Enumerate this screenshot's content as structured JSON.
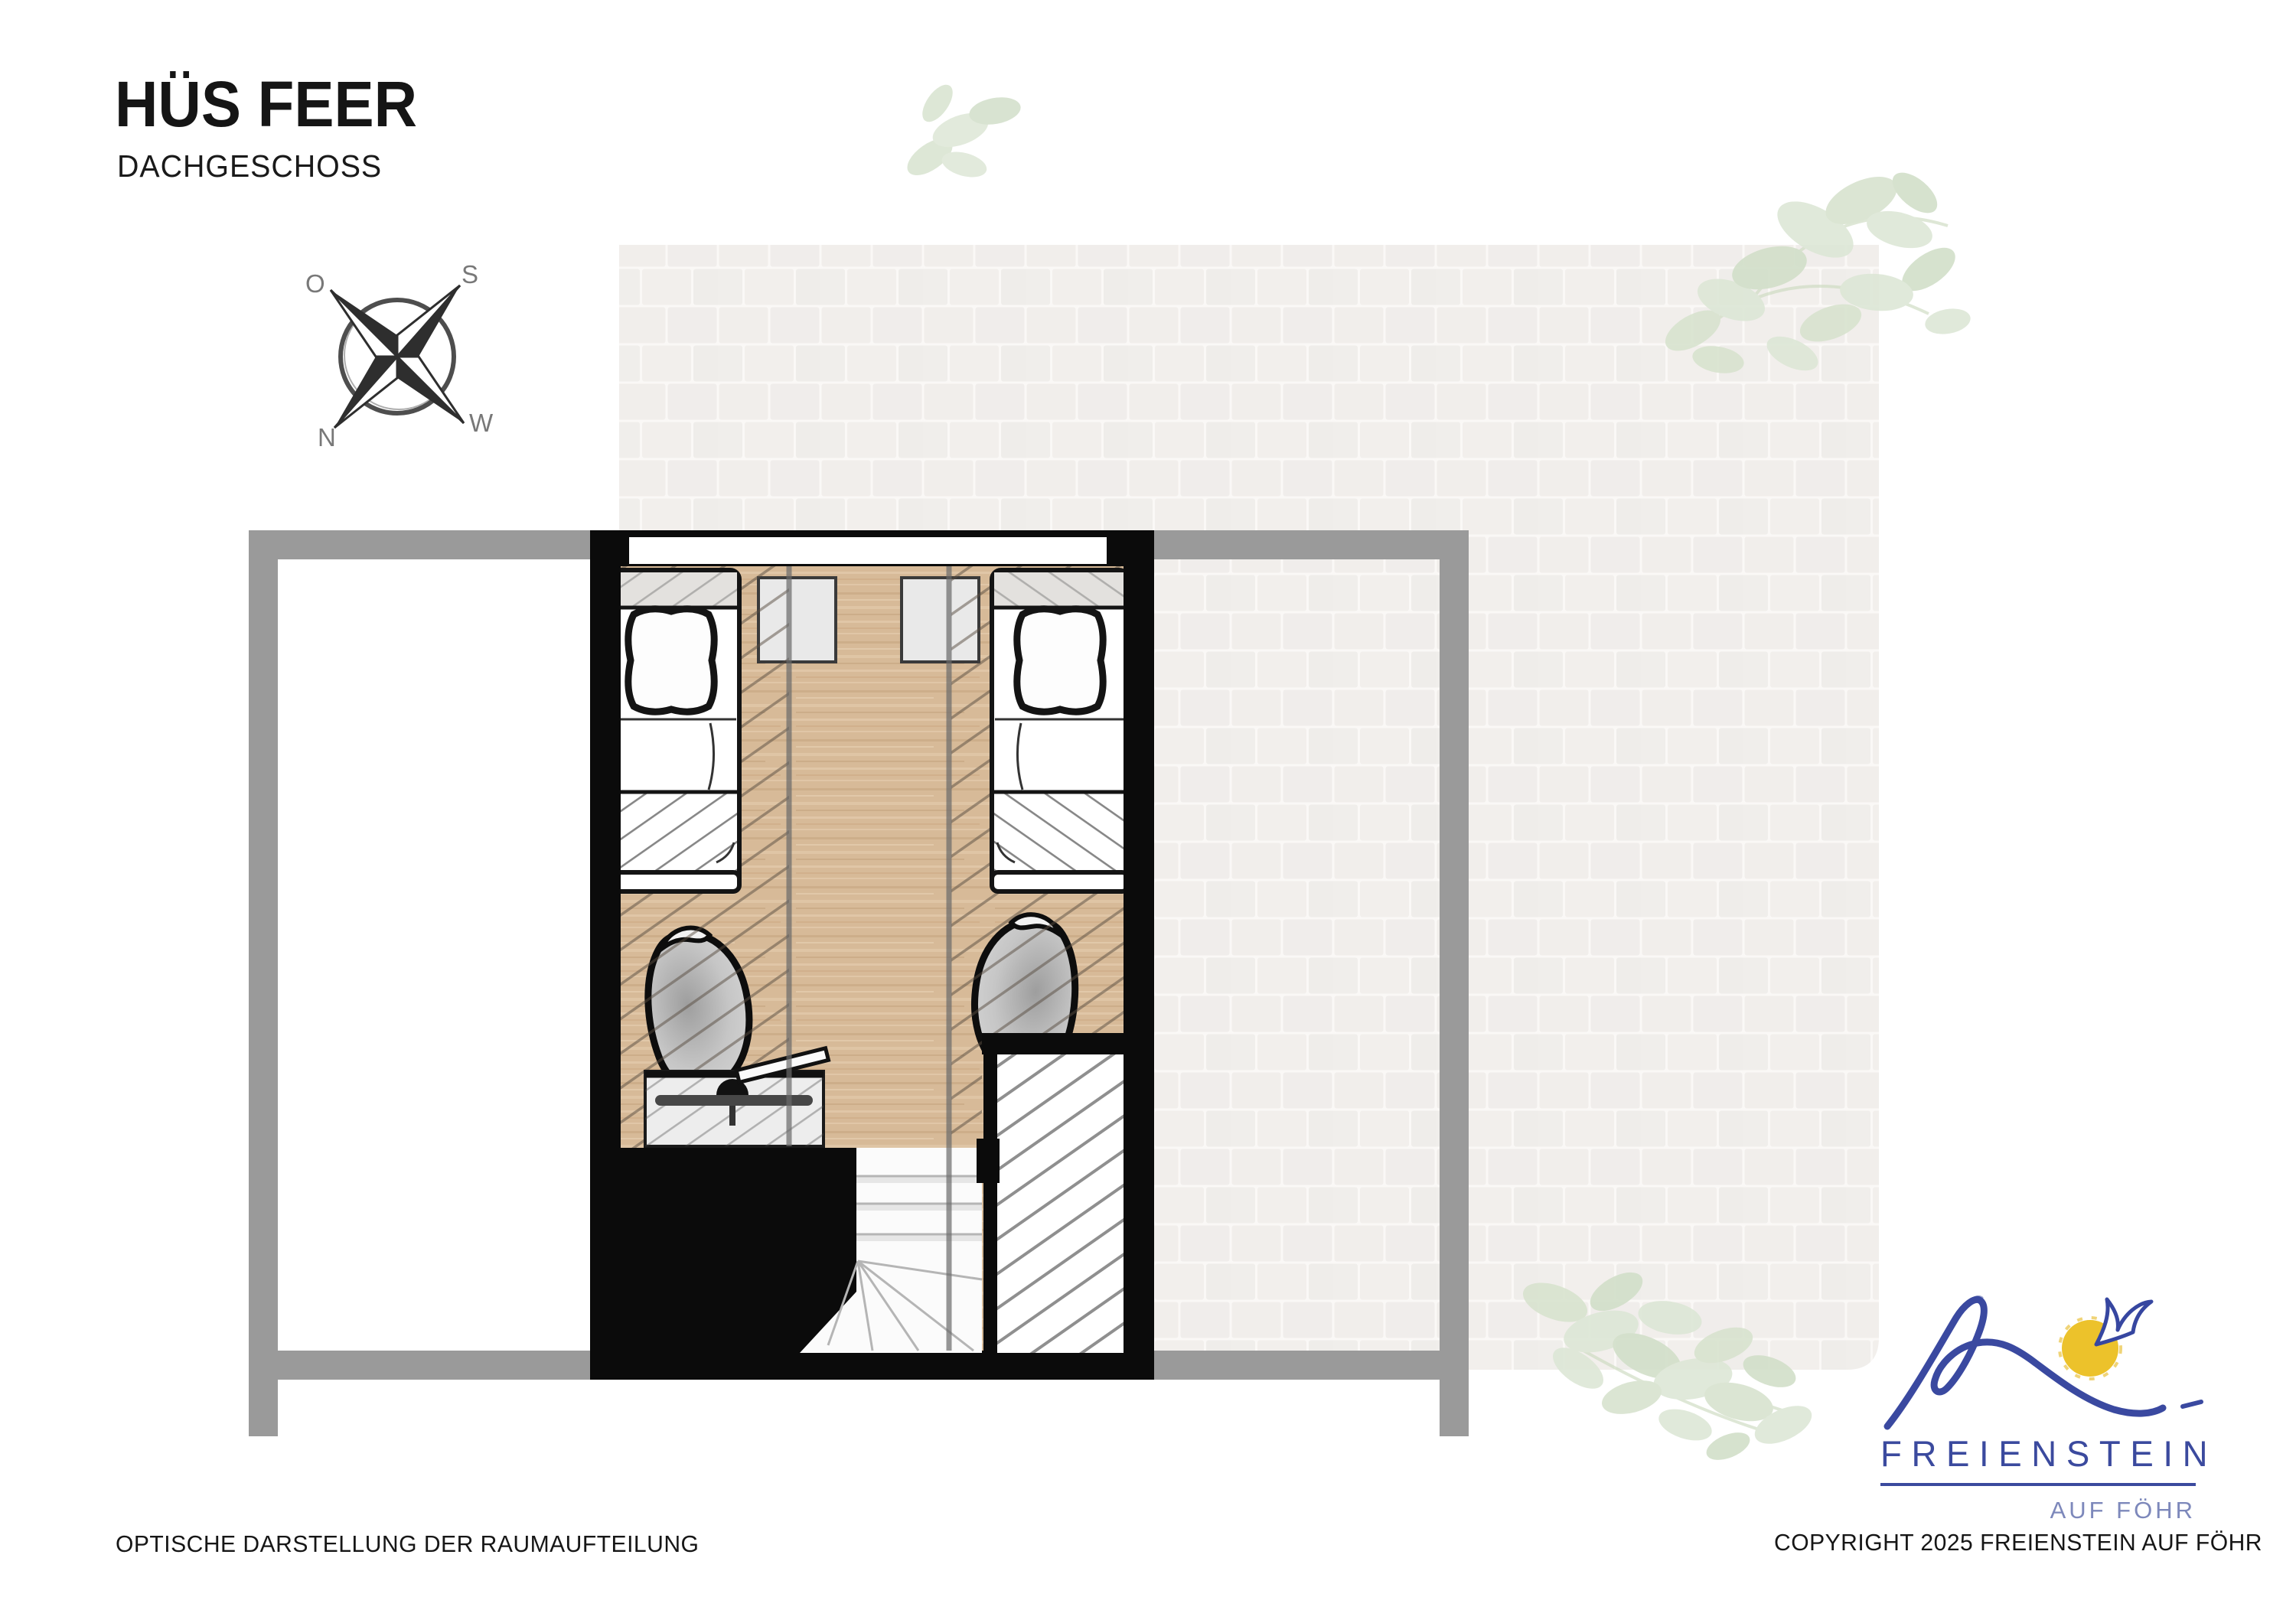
{
  "page": {
    "title": "HÜS FEER",
    "subtitle": "DACHGESCHOSS"
  },
  "compass": {
    "o": "O",
    "s": "S",
    "n": "N",
    "w": "W"
  },
  "footer": {
    "left": "OPTISCHE DARSTELLUNG DER RAUMAUFTEILUNG",
    "right": "COPYRIGHT 2025 FREIENSTEIN AUF FÖHR"
  },
  "logo": {
    "brand": "FREIENSTEIN",
    "tagline": "AUF FÖHR"
  },
  "colors": {
    "wall_black": "#0b0b0b",
    "railing_gray": "#9a9a9a",
    "floor_wood": "#d7ba98",
    "brick_background": "#f1efec",
    "foliage_green": "#dbe5d3",
    "logo_blue": "#3b4a9e",
    "logo_light_blue": "#7d88bb",
    "sun_yellow": "#ecc22b"
  }
}
